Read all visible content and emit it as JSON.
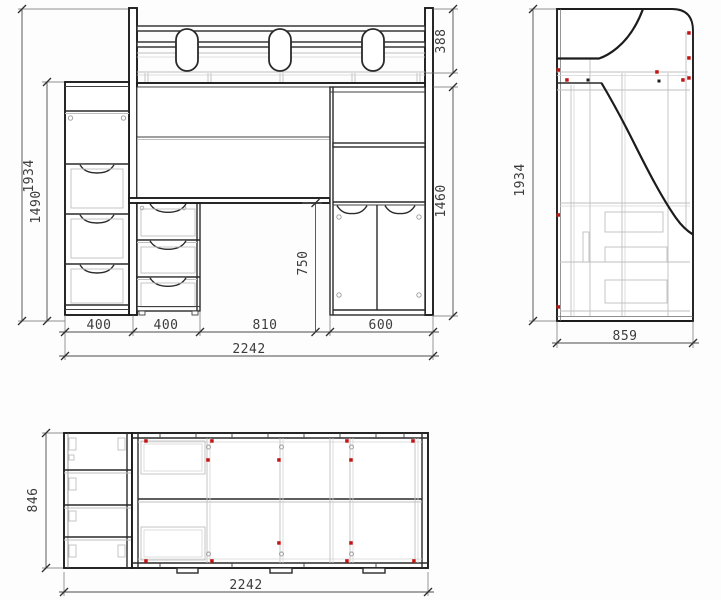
{
  "drawing": {
    "type": "furniture-blueprint",
    "views": {
      "front": {
        "total_height_mm": "1934",
        "cabinet_height_mm": "1490",
        "guard_rail_height_mm": "388",
        "wardrobe_height_mm": "1460",
        "desk_height_mm": "750",
        "cabinet_width_mm": "400",
        "drawer_unit_width_mm": "400",
        "desk_opening_width_mm": "810",
        "wardrobe_width_mm": "600",
        "total_width_mm": "2242"
      },
      "side": {
        "total_height_mm": "1934",
        "total_depth_mm": "859"
      },
      "plan": {
        "total_depth_mm": "846",
        "total_width_mm": "2242"
      }
    },
    "colors": {
      "line": "#1c1c1c",
      "hidden_line": "#bfbfbf",
      "fastener_marker": "#c31414"
    }
  }
}
